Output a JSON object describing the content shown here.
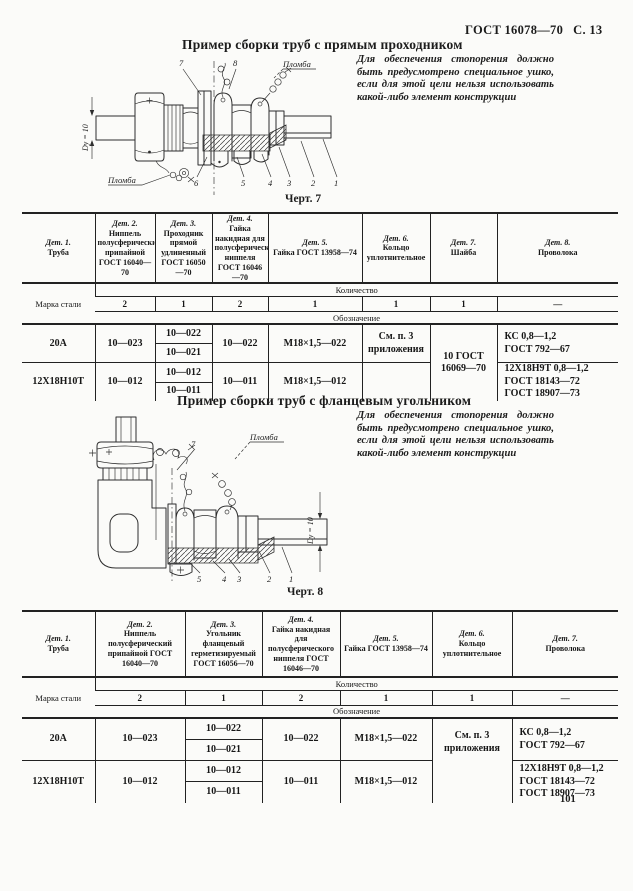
{
  "header": {
    "standard": "ГОСТ 16078—70",
    "page_ref": "С. 13"
  },
  "page_number": "101",
  "section1": {
    "title": "Пример сборки труб с прямым проходником",
    "note": "Для обеспечения стопорения должно быть предусмотрено специальное ушко, если для этой цели нельзя использовать какой-либо элемент конструкции",
    "figure": {
      "caption": "Черт. 7",
      "dim_label": "Dу = 10",
      "seal_top": "Пломба",
      "seal_bottom": "Пломба",
      "callout_7": "7",
      "callout_8": "8",
      "part_numbers": [
        "6",
        "5",
        "4",
        "3",
        "2",
        "1"
      ]
    },
    "table": {
      "headers": [
        {
          "det": "Дет. 1.",
          "name": "Труба"
        },
        {
          "det": "Дет. 2.",
          "name": "Ниппель полусферический припайной ГОСТ 16040—70"
        },
        {
          "det": "Дет. 3.",
          "name": "Проходник прямой удлиненный ГОСТ 16050—70"
        },
        {
          "det": "Дет. 4.",
          "name": "Гайка накидная для полусферического ниппеля ГОСТ 16046—70"
        },
        {
          "det": "Дет. 5.",
          "name": "Гайка ГОСТ 13958—74"
        },
        {
          "det": "Дет. 6.",
          "name": "Кольцо уплотнительное"
        },
        {
          "det": "Дет. 7.",
          "name": "Шайба"
        },
        {
          "det": "Дет. 8.",
          "name": "Проволока"
        }
      ],
      "steel_grade_label": "Марка стали",
      "quantity_label": "Количество",
      "quantities": [
        "2",
        "1",
        "2",
        "1",
        "1",
        "1",
        "—"
      ],
      "designation_label": "Обозначение",
      "det7_merged": "10 ГОСТ\n16069—70",
      "rows": [
        {
          "steel": "20А",
          "det2": "10—023",
          "det3a": "10—022",
          "det3b": "10—021",
          "det4": "10—022",
          "det5": "М18×1,5—022",
          "det6": "См. п. 3\nприложения",
          "det8": "КС 0,8—1,2\nГОСТ 792—67"
        },
        {
          "steel": "12Х18Н10Т",
          "det2": "10—012",
          "det3a": "10—012",
          "det3b": "10—011",
          "det4": "10—011",
          "det5": "М18×1,5—012",
          "det6": "",
          "det8": "12Х18Н9Т 0,8—1,2\nГОСТ 18143—72\nГОСТ 18907—73"
        }
      ]
    }
  },
  "section2": {
    "title": "Пример сборки труб с фланцевым угольником",
    "note": "Для обеспечения стопорения должно быть предусмотрено специальное ушко, если для этой цели нельзя использовать какой-либо элемент конструкции",
    "figure": {
      "caption": "Черт. 8",
      "dim_label": "Dу = 10",
      "seal_top": "Пломба",
      "callout_7": "7",
      "part_numbers": [
        "5",
        "4",
        "3",
        "2",
        "1"
      ]
    },
    "table": {
      "headers": [
        {
          "det": "Дет. 1.",
          "name": "Труба"
        },
        {
          "det": "Дет. 2.",
          "name": "Ниппель полусферический припайной ГОСТ 16040—70"
        },
        {
          "det": "Дет. 3.",
          "name": "Угольник фланцевый герметизируемый ГОСТ 16056—70"
        },
        {
          "det": "Дет. 4.",
          "name": "Гайка накидная для полусферического ниппеля ГОСТ 16046—70"
        },
        {
          "det": "Дет. 5.",
          "name": "Гайка ГОСТ 13958—74"
        },
        {
          "det": "Дет. 6.",
          "name": "Кольцо уплотнительное"
        },
        {
          "det": "Дет. 7.",
          "name": "Проволока"
        }
      ],
      "steel_grade_label": "Марка стали",
      "quantity_label": "Количество",
      "quantities": [
        "2",
        "1",
        "2",
        "1",
        "1",
        "—"
      ],
      "designation_label": "Обозначение",
      "det6_merged": "См. п. 3\nприложения",
      "rows": [
        {
          "steel": "20А",
          "det2": "10—023",
          "det3a": "10—022",
          "det3b": "10—021",
          "det4": "10—022",
          "det5": "М18×1,5—022",
          "det7": "КС 0,8—1,2\nГОСТ 792—67"
        },
        {
          "steel": "12Х18Н10Т",
          "det2": "10—012",
          "det3a": "10—012",
          "det3b": "10—011",
          "det4": "10—011",
          "det5": "М18×1,5—012",
          "det7": "12Х18Н9Т 0,8—1,2\nГОСТ 18143—72\nГОСТ 18907—73"
        }
      ]
    }
  }
}
